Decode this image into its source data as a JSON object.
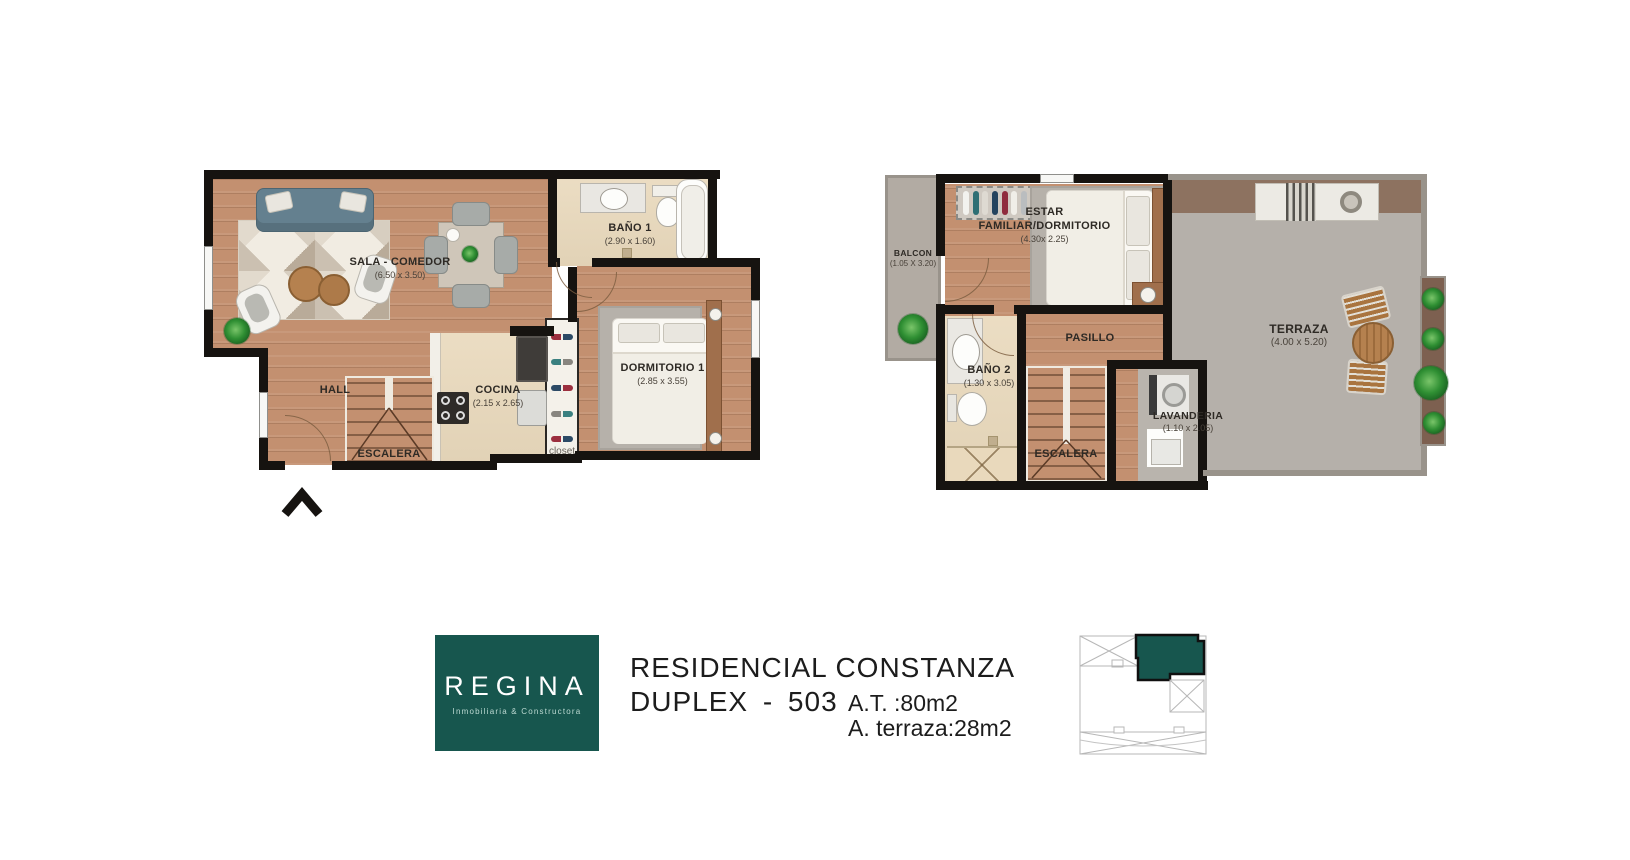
{
  "colors": {
    "brand_teal": "#17564e",
    "wall_black": "#161310",
    "wood_floor": "#c39070",
    "tile_beige": "#e9d9bc",
    "terrace_gray": "#b5b0aa",
    "band_brown": "#8d7260"
  },
  "plans": {
    "first_floor": {
      "sala": {
        "label": "SALA - COMEDOR",
        "dims": "(6.50 x 3.50)"
      },
      "bano1": {
        "label": "BAÑO 1",
        "dims": "(2.90 x 1.60)"
      },
      "dormitorio1": {
        "label": "DORMITORIO 1",
        "dims": "(2.85 x 3.55)"
      },
      "cocina": {
        "label": "COCINA",
        "dims": "(2.15 x 2.65)"
      },
      "hall": {
        "label": "HALL"
      },
      "escalera": {
        "label": "ESCALERA"
      },
      "closet": {
        "label": "closet"
      }
    },
    "second_floor": {
      "balcon": {
        "label": "BALCON",
        "dims": "(1.05 X 3.20)"
      },
      "estar": {
        "label_line1": "ESTAR",
        "label_line2": "FAMILIAR/DORMITORIO",
        "dims": "(4.30x 2.25)"
      },
      "pasillo": {
        "label": "PASILLO"
      },
      "bano2": {
        "label": "BAÑO 2",
        "dims": "(1.30 x 3.05)"
      },
      "escalera": {
        "label": "ESCALERA"
      },
      "lavanderia": {
        "label": "LAVANDERIA",
        "dims": "(1.10 x 2.05)"
      },
      "terraza": {
        "label": "TERRAZA",
        "dims": "(4.00 x 5.20)"
      }
    }
  },
  "footer": {
    "logo": {
      "brand": "REGINA",
      "tagline": "Inmobiliaria & Constructora"
    },
    "project_title": "RESIDENCIAL CONSTANZA",
    "unit_title": "DUPLEX - 503",
    "area_total": "A.T. :80m2",
    "area_terrace": "A. terraza:28m2"
  }
}
